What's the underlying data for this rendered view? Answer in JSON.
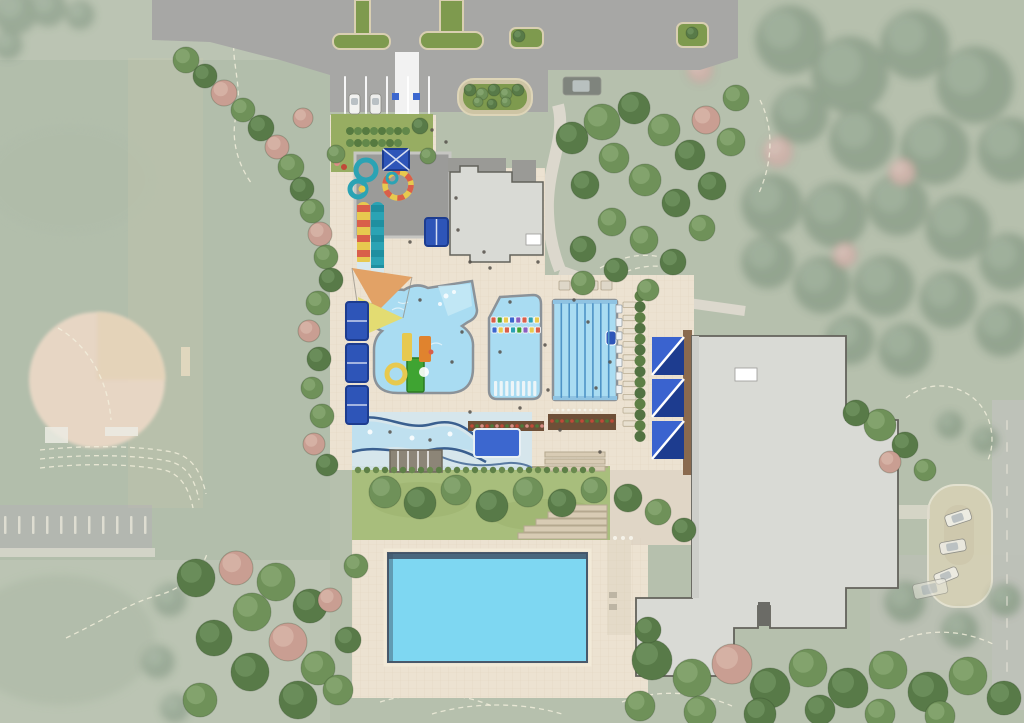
{
  "meta": {
    "type": "architectural-site-plan",
    "subject": "aquatic-center-concept-plan"
  },
  "colors": {
    "base_green": "#aab6a0",
    "field_green": "#9fae97",
    "asphalt": "#a7a7a5",
    "island_green": "#7e9a4e",
    "curb_tan": "#d9cfb2",
    "deck": "#ece2d1",
    "walk": "#dcd8cd",
    "pool_water": "#a9dcf2",
    "pool_entry": "#c6e9f6",
    "pool_edge": "#8b9298",
    "lane_line": "#4e93c6",
    "big_pool": "#7ed7f2",
    "big_pool_edge": "#3f5468",
    "royal": "#2e55b8",
    "royal_light": "#3a63cf",
    "royal_dark": "#1d3c8f",
    "plunge": "#3c67cf",
    "building": "#d9dad5",
    "building_shade": "#cdcec9",
    "building_line": "#63625b",
    "roof_dark": "#9a9a96",
    "boardwalk": "#8a6a4e",
    "lawn": "#a8be7c",
    "garden": "#97ad62",
    "sail_orange": "#e2a266",
    "sail_yellow": "#e3dc72",
    "slide_teal": "#2ba3b4",
    "slide_teal_dark": "#1f8fa0",
    "slide_red": "#d95f4a",
    "slide_yellow": "#e7c94f",
    "play_green": "#3fa432",
    "play_orange": "#e0832e",
    "planter_brown": "#6e4f37",
    "pad_gray": "#9b9b99",
    "field_clay": "#e9d0ba",
    "contour": "#f4f0dd",
    "road": "#b6bab0",
    "loop_tan": "#d2cbaa",
    "pink_roof": "#e5b0a2",
    "river_base": "#d4e7ee",
    "navy_wave": "#3a5f8f",
    "step_tan": "#d8cbb4",
    "step_line": "#b5a88f",
    "white": "#ffffff"
  },
  "scene": {
    "tree_types": {
      "g": {
        "f": "#6f9159",
        "h": "#85a56f"
      },
      "d": {
        "f": "#587a48",
        "h": "#6d8f5c"
      },
      "p": {
        "f": "#c99e92",
        "h": "#d6b2a6"
      },
      "f": {
        "f": "#7e937a",
        "h": "#90a38c"
      },
      "pf": {
        "f": "#c7a49b",
        "h": "#d4b6ad"
      }
    },
    "trees_crisp": [
      [
        186,
        60,
        13,
        "g"
      ],
      [
        205,
        76,
        12,
        "d"
      ],
      [
        224,
        93,
        13,
        "p"
      ],
      [
        243,
        110,
        12,
        "g"
      ],
      [
        261,
        128,
        13,
        "d"
      ],
      [
        277,
        147,
        12,
        "p"
      ],
      [
        291,
        167,
        13,
        "g"
      ],
      [
        302,
        189,
        12,
        "d"
      ],
      [
        312,
        211,
        12,
        "g"
      ],
      [
        320,
        234,
        12,
        "p"
      ],
      [
        326,
        257,
        12,
        "g"
      ],
      [
        331,
        280,
        12,
        "d"
      ],
      [
        318,
        303,
        12,
        "g"
      ],
      [
        309,
        331,
        11,
        "p"
      ],
      [
        319,
        359,
        12,
        "d"
      ],
      [
        312,
        388,
        11,
        "g"
      ],
      [
        322,
        416,
        12,
        "g"
      ],
      [
        314,
        444,
        11,
        "p"
      ],
      [
        327,
        465,
        11,
        "d"
      ],
      [
        336,
        154,
        9,
        "g"
      ],
      [
        420,
        126,
        8,
        "d"
      ],
      [
        428,
        156,
        8,
        "g"
      ],
      [
        303,
        118,
        10,
        "p"
      ],
      [
        470,
        90,
        6,
        "d"
      ],
      [
        482,
        94,
        6,
        "g"
      ],
      [
        494,
        90,
        6,
        "d"
      ],
      [
        506,
        94,
        6,
        "g"
      ],
      [
        518,
        90,
        6,
        "d"
      ],
      [
        478,
        102,
        5,
        "g"
      ],
      [
        492,
        104,
        5,
        "d"
      ],
      [
        506,
        102,
        5,
        "g"
      ],
      [
        519,
        36,
        6,
        "d"
      ],
      [
        692,
        33,
        6,
        "d"
      ],
      [
        572,
        138,
        16,
        "d"
      ],
      [
        602,
        122,
        18,
        "g"
      ],
      [
        634,
        108,
        16,
        "d"
      ],
      [
        664,
        130,
        16,
        "g"
      ],
      [
        690,
        155,
        15,
        "d"
      ],
      [
        614,
        158,
        15,
        "g"
      ],
      [
        585,
        185,
        14,
        "d"
      ],
      [
        645,
        180,
        16,
        "g"
      ],
      [
        676,
        203,
        14,
        "d"
      ],
      [
        612,
        222,
        14,
        "g"
      ],
      [
        583,
        249,
        13,
        "d"
      ],
      [
        644,
        240,
        14,
        "g"
      ],
      [
        673,
        262,
        13,
        "d"
      ],
      [
        702,
        228,
        13,
        "g"
      ],
      [
        712,
        186,
        14,
        "d"
      ],
      [
        731,
        142,
        14,
        "g"
      ],
      [
        706,
        120,
        14,
        "p"
      ],
      [
        736,
        98,
        13,
        "g"
      ],
      [
        583,
        283,
        12,
        "g"
      ],
      [
        616,
        270,
        12,
        "d"
      ],
      [
        648,
        290,
        11,
        "g"
      ],
      [
        385,
        492,
        16,
        "g"
      ],
      [
        420,
        503,
        16,
        "d"
      ],
      [
        456,
        490,
        15,
        "g"
      ],
      [
        492,
        506,
        16,
        "d"
      ],
      [
        528,
        492,
        15,
        "g"
      ],
      [
        562,
        503,
        14,
        "d"
      ],
      [
        594,
        490,
        13,
        "g"
      ],
      [
        628,
        498,
        14,
        "d"
      ],
      [
        658,
        512,
        13,
        "g"
      ],
      [
        684,
        530,
        12,
        "d"
      ],
      [
        196,
        578,
        19,
        "d"
      ],
      [
        236,
        568,
        17,
        "p"
      ],
      [
        276,
        582,
        19,
        "g"
      ],
      [
        310,
        606,
        17,
        "d"
      ],
      [
        252,
        612,
        19,
        "g"
      ],
      [
        214,
        638,
        18,
        "d"
      ],
      [
        288,
        642,
        19,
        "p"
      ],
      [
        318,
        668,
        17,
        "g"
      ],
      [
        250,
        672,
        19,
        "d"
      ],
      [
        200,
        700,
        17,
        "g"
      ],
      [
        298,
        700,
        19,
        "d"
      ],
      [
        338,
        690,
        15,
        "g"
      ],
      [
        348,
        640,
        13,
        "d"
      ],
      [
        330,
        600,
        12,
        "p"
      ],
      [
        356,
        566,
        12,
        "g"
      ],
      [
        652,
        660,
        20,
        "d"
      ],
      [
        692,
        678,
        19,
        "g"
      ],
      [
        732,
        664,
        20,
        "p"
      ],
      [
        770,
        688,
        20,
        "d"
      ],
      [
        808,
        668,
        19,
        "g"
      ],
      [
        848,
        688,
        20,
        "d"
      ],
      [
        888,
        670,
        19,
        "g"
      ],
      [
        928,
        692,
        20,
        "d"
      ],
      [
        968,
        676,
        19,
        "g"
      ],
      [
        1004,
        698,
        17,
        "d"
      ],
      [
        700,
        712,
        16,
        "g"
      ],
      [
        760,
        714,
        16,
        "d"
      ],
      [
        640,
        706,
        15,
        "g"
      ],
      [
        880,
        714,
        15,
        "g"
      ],
      [
        820,
        710,
        15,
        "d"
      ],
      [
        940,
        716,
        15,
        "g"
      ],
      [
        648,
        630,
        13,
        "d"
      ],
      [
        880,
        425,
        16,
        "g"
      ],
      [
        856,
        413,
        13,
        "d"
      ],
      [
        905,
        445,
        13,
        "d"
      ],
      [
        925,
        470,
        11,
        "g"
      ],
      [
        890,
        462,
        11,
        "p"
      ]
    ],
    "trees_faded_green": [
      [
        790,
        40,
        34
      ],
      [
        850,
        75,
        38
      ],
      [
        915,
        45,
        34
      ],
      [
        975,
        85,
        38
      ],
      [
        1010,
        150,
        32
      ],
      [
        935,
        150,
        34
      ],
      [
        862,
        140,
        32
      ],
      [
        800,
        115,
        28
      ],
      [
        772,
        205,
        30
      ],
      [
        835,
        215,
        32
      ],
      [
        898,
        205,
        30
      ],
      [
        958,
        228,
        32
      ],
      [
        1008,
        262,
        28
      ],
      [
        822,
        285,
        28
      ],
      [
        884,
        286,
        30
      ],
      [
        948,
        300,
        28
      ],
      [
        1002,
        330,
        26
      ],
      [
        768,
        262,
        26
      ],
      [
        905,
        350,
        26
      ],
      [
        850,
        340,
        24
      ],
      [
        15,
        12,
        22
      ],
      [
        48,
        8,
        18
      ],
      [
        80,
        15,
        14
      ],
      [
        8,
        45,
        14
      ],
      [
        170,
        600,
        16
      ],
      [
        158,
        662,
        16
      ],
      [
        175,
        708,
        14
      ],
      [
        950,
        425,
        13
      ],
      [
        985,
        440,
        13
      ],
      [
        905,
        602,
        20
      ],
      [
        960,
        630,
        18
      ],
      [
        1005,
        600,
        16
      ]
    ],
    "trees_faded_pink": [
      [
        778,
        152,
        15
      ],
      [
        902,
        172,
        13
      ],
      [
        845,
        255,
        12
      ],
      [
        700,
        70,
        13
      ]
    ],
    "contours": [
      "M40,450 C95,444 145,447 172,452 C192,456 201,472 206,494",
      "M40,459 C95,453 142,456 168,461 C187,465 195,480 199,500",
      "M40,468 C92,462 138,465 164,470 C181,474 189,489 193,508",
      "M66,638 C100,622 132,602 156,596 C182,589 200,574 207,554",
      "M236,28 C228,58 244,84 236,116 C230,142 240,168 252,184",
      "M58,328 C86,344 108,378 111,420",
      "M380,702 C420,690 462,693 492,706",
      "M432,714 C472,702 522,702 562,714",
      "M622,702 C660,688 700,692 732,706",
      "M600,268 C626,254 652,251 674,262",
      "M610,279 C636,265 660,262 680,272",
      "M906,398 C926,382 952,382 972,397 C992,412 997,442 987,462",
      "M900,640 C930,628 965,630 995,645",
      "M760,100 C775,130 772,165 758,195"
    ],
    "people": [
      [
        432,
        130
      ],
      [
        446,
        142
      ],
      [
        458,
        230
      ],
      [
        470,
        262
      ],
      [
        490,
        268
      ],
      [
        538,
        262
      ],
      [
        420,
        300
      ],
      [
        462,
        332
      ],
      [
        452,
        362
      ],
      [
        500,
        352
      ],
      [
        545,
        345
      ],
      [
        548,
        390
      ],
      [
        520,
        408
      ],
      [
        560,
        430
      ],
      [
        600,
        452
      ],
      [
        430,
        440
      ],
      [
        390,
        432
      ],
      [
        574,
        300
      ],
      [
        588,
        322
      ],
      [
        610,
        362
      ],
      [
        596,
        388
      ],
      [
        470,
        412
      ],
      [
        510,
        302
      ],
      [
        484,
        252
      ],
      [
        456,
        198
      ],
      [
        410,
        242
      ]
    ],
    "cars": [
      {
        "x": 349,
        "y": 94,
        "w": 11,
        "h": 20,
        "rot": 0,
        "body": "#f2f2f0",
        "opacity": 1
      },
      {
        "x": 370,
        "y": 94,
        "w": 11,
        "h": 20,
        "rot": 0,
        "body": "#eeeeec",
        "opacity": 1
      },
      {
        "x": 563,
        "y": 77,
        "w": 38,
        "h": 18,
        "rot": 0,
        "body": "#6d716d",
        "opacity": 0.75
      },
      {
        "x": 944,
        "y": 516,
        "w": 26,
        "h": 12,
        "rot": -18,
        "body": "#f0efe8",
        "opacity": 0.9
      },
      {
        "x": 939,
        "y": 543,
        "w": 26,
        "h": 12,
        "rot": -10,
        "body": "#eceae2",
        "opacity": 0.9
      },
      {
        "x": 933,
        "y": 575,
        "w": 24,
        "h": 11,
        "rot": -22,
        "body": "#f0efe8",
        "opacity": 0.85
      },
      {
        "x": 912,
        "y": 585,
        "w": 34,
        "h": 15,
        "rot": -12,
        "body": "#e8e6dc",
        "opacity": 0.6
      }
    ],
    "repeats": [
      {
        "name": "floatables-row-1",
        "layer": "crisp",
        "shape": "rect",
        "x": 491,
        "y": 317,
        "dx": 6.2,
        "dy": 0,
        "w": 5,
        "h": 6,
        "count": 8,
        "colors": [
          "#d95f4a",
          "#3fa432",
          "#e7c94f",
          "#3c67cf",
          "#8a5fc0",
          "#d95f4a",
          "#2ba3b4",
          "#e7c94f"
        ],
        "stroke": "#ffffff"
      },
      {
        "name": "floatables-row-2",
        "layer": "crisp",
        "shape": "rect",
        "x": 492,
        "y": 327,
        "dx": 6.2,
        "dy": 0,
        "w": 5,
        "h": 6,
        "count": 8,
        "colors": [
          "#3c67cf",
          "#e7c94f",
          "#d95f4a",
          "#2ba3b4",
          "#3fa432",
          "#8a5fc0",
          "#e7c94f",
          "#d95f4a"
        ],
        "stroke": "#ffffff"
      },
      {
        "name": "in-pool-loungers",
        "layer": "crisp",
        "shape": "rect",
        "x": 494,
        "y": 381,
        "dx": 5.6,
        "dy": 0,
        "w": 3.2,
        "h": 15,
        "count": 8,
        "colors": [
          "#f2f6f8"
        ],
        "opacity": 0.92
      },
      {
        "name": "lap-lane-lines",
        "layer": "crisp",
        "shape": "rect",
        "x": 560.5,
        "y": 303,
        "dx": 7.9,
        "dy": 0,
        "w": 1.6,
        "h": 95,
        "count": 7,
        "colors": [
          "#4e93c6"
        ]
      },
      {
        "name": "lounge-chairs",
        "layer": "crisp",
        "shape": "rect",
        "x": 623,
        "y": 302,
        "dx": 0,
        "dy": 13.2,
        "w": 13,
        "h": 5.5,
        "count": 10,
        "colors": [
          "#e8e0d0"
        ],
        "stroke": "#b9ad94"
      },
      {
        "name": "hedge-row",
        "layer": "crisp",
        "shape": "circle",
        "x": 640,
        "y": 296,
        "dx": 0,
        "dy": 10.8,
        "r": 5.5,
        "count": 14,
        "colors": [
          "#5d7f46",
          "#527242"
        ]
      },
      {
        "name": "lawn-hedge",
        "layer": "crisp",
        "shape": "circle",
        "x": 358,
        "y": 470,
        "dx": 9,
        "dy": 0,
        "r": 3.2,
        "count": 27,
        "colors": [
          "#6a8a4e",
          "#5d7f46"
        ]
      },
      {
        "name": "garden-hedge-1",
        "layer": "crisp",
        "shape": "circle",
        "x": 350,
        "y": 131,
        "dx": 8,
        "dy": 0,
        "r": 4,
        "count": 8,
        "colors": [
          "#567a40",
          "#62884a"
        ]
      },
      {
        "name": "garden-hedge-2",
        "layer": "crisp",
        "shape": "circle",
        "x": 350,
        "y": 143,
        "dx": 8,
        "dy": 0,
        "r": 4,
        "count": 7,
        "colors": [
          "#62884a",
          "#567a40"
        ]
      },
      {
        "name": "bleachers",
        "layer": "crisp",
        "shape": "rect",
        "x": 559,
        "y": 281,
        "dx": 14,
        "dy": 0,
        "w": 11,
        "h": 9,
        "count": 4,
        "colors": [
          "#ded7c8"
        ],
        "stroke": "#b0a48c"
      },
      {
        "name": "starting-blocks",
        "layer": "crisp",
        "shape": "rect",
        "x": 616,
        "y": 305,
        "dx": 0,
        "dy": 13.4,
        "w": 6,
        "h": 8,
        "count": 7,
        "colors": [
          "#eef2f4"
        ],
        "stroke": "#9aa2a8"
      },
      {
        "name": "planter-flowers-1",
        "layer": "crisp",
        "shape": "circle",
        "x": 472,
        "y": 426,
        "dx": 5,
        "dy": 0,
        "r": 1.8,
        "count": 15,
        "colors": [
          "#c04a38",
          "#4e7a3a",
          "#d98f86"
        ]
      },
      {
        "name": "planter-flowers-2",
        "layer": "crisp",
        "shape": "circle",
        "x": 552,
        "y": 421,
        "dx": 5,
        "dy": 0,
        "r": 1.8,
        "count": 13,
        "colors": [
          "#c04a38",
          "#4e7a3a"
        ]
      },
      {
        "name": "bollards",
        "layer": "crisp",
        "shape": "circle",
        "x": 552,
        "y": 410,
        "dx": 5.5,
        "dy": 0,
        "r": 1.4,
        "count": 10,
        "colors": [
          "#f5f2e8"
        ]
      },
      {
        "name": "stall-lines",
        "layer": "crisp",
        "shape": "rect",
        "x": 344,
        "y": 76,
        "dx": 21,
        "dy": 0,
        "w": 2,
        "h": 38,
        "count": 5,
        "colors": [
          "#ffffff"
        ],
        "opacity": 0.9
      },
      {
        "name": "parking-stripes",
        "layer": "faded",
        "shape": "rect",
        "x": 4,
        "y": 516,
        "dx": 14,
        "dy": 0,
        "w": 2.5,
        "h": 18,
        "count": 11,
        "colors": [
          "#e9e6da"
        ],
        "opacity": 0.8
      },
      {
        "name": "road-dashes",
        "layer": "faded",
        "shape": "rect",
        "x": 1006,
        "y": 420,
        "dx": 0,
        "dy": 22,
        "w": 2,
        "h": 10,
        "count": 12,
        "colors": [
          "#e9e6da"
        ],
        "opacity": 0.5
      }
    ]
  }
}
